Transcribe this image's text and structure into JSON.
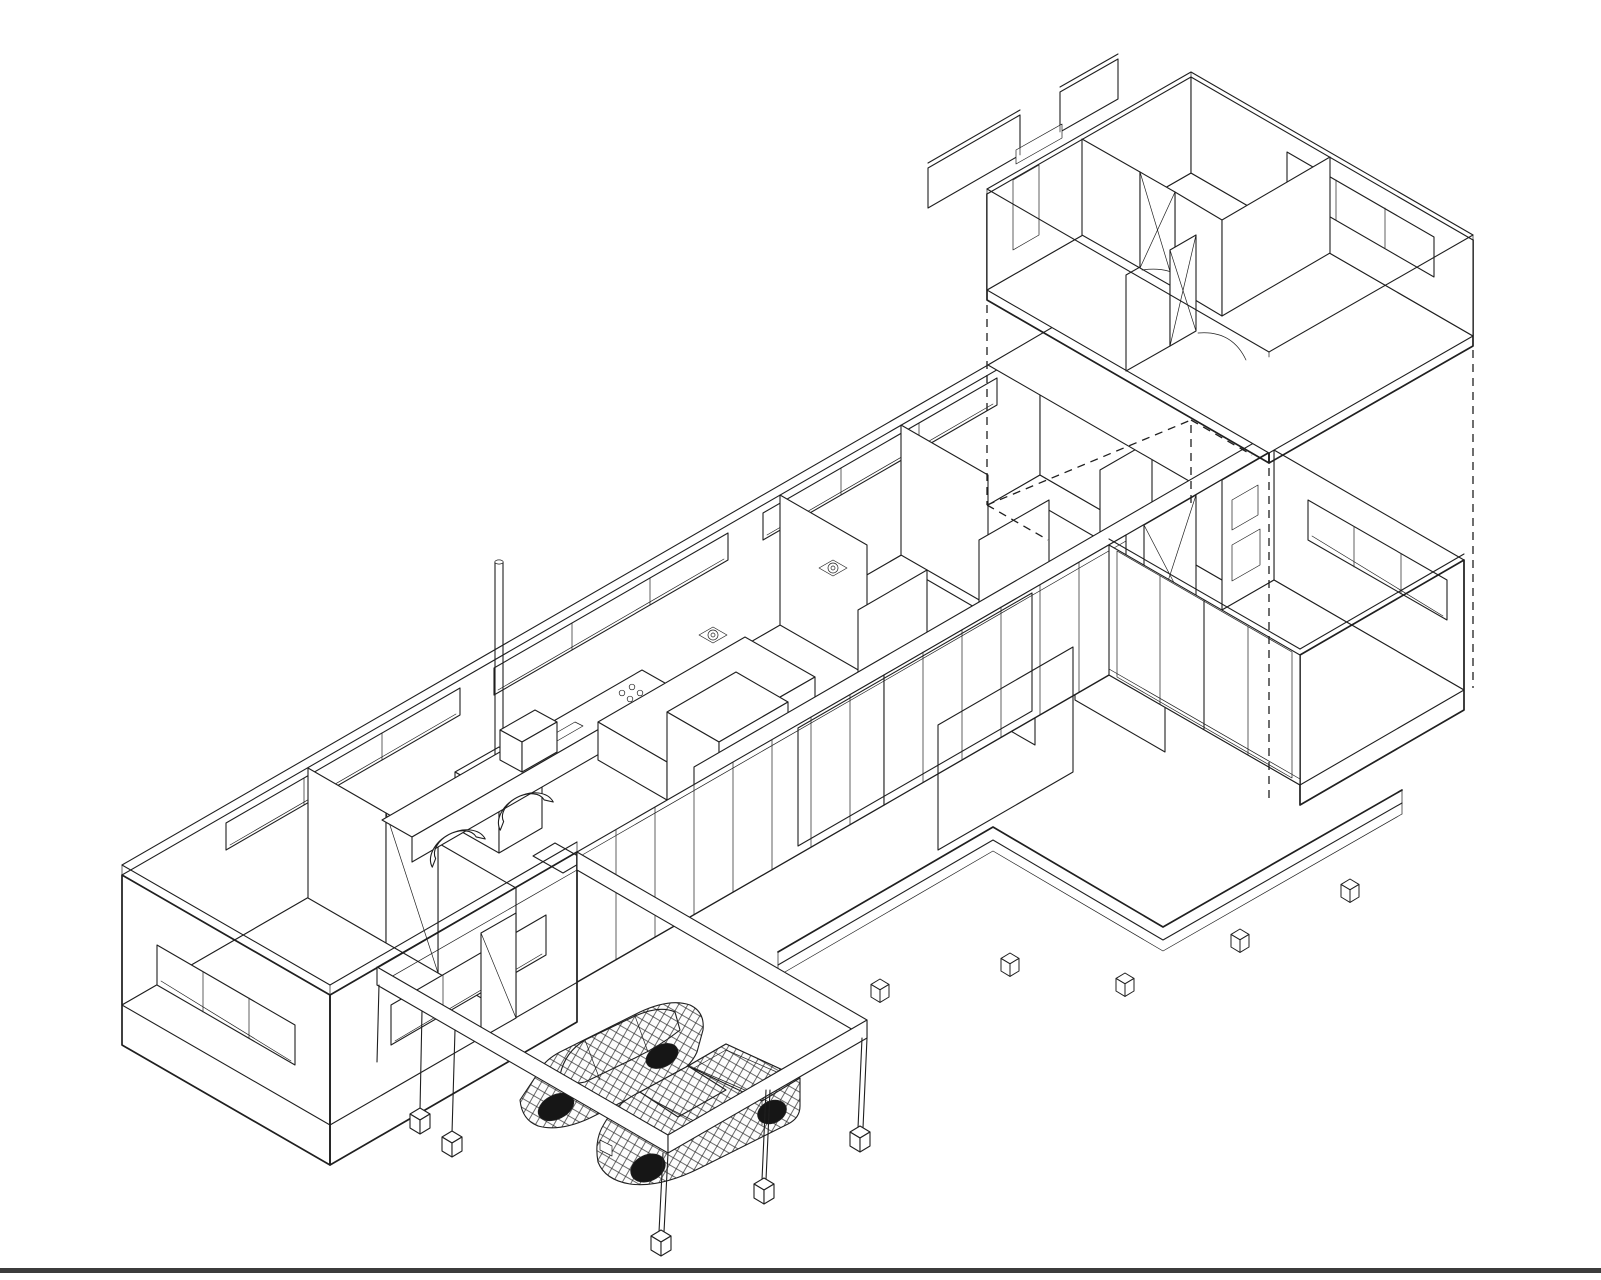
{
  "scene": {
    "style_vars": "--bg:#ffffff;--ln:#1f1f1f;--border:#3c3c3c",
    "background": "#ffffff",
    "line_color": "#1f1f1f",
    "border_color": "#3c3c3c",
    "drawing_type": "exploded axonometric architectural line drawing",
    "projection": "isometric 30-degree",
    "sheet_border_bottom": true
  },
  "components": {
    "upper_floor_module": "detached upper-storey box with open top, interior partitions, vertical board cladding and ribbon windows",
    "projection_lines": "vertical dashed lines locating the lifted module over the ground floor",
    "ground_floor": "long open-top floor plan with lounge, kitchen-dining, bedrooms, bathrooms, entry and stair",
    "right_wing": "single-storey wing with vertical cladding and full-height sliding glazing",
    "lounge_wing": "left end with horizontal lap cladding and ribbon windows",
    "carport": "open beam frame on slender posts with cube footings",
    "vehicles": [
      "wireframe SUV",
      "wireframe pickup truck"
    ],
    "deck": "L-shaped timber deck edge with pad footings",
    "louvre_screens": "freestanding horizontal-slat privacy screens",
    "slat_screens": "vertical slat screens beside the stair",
    "furniture": [
      "wood stove with flue",
      "kitchen island",
      "bench",
      "rear counter with sink and cooktop",
      "tall cabinets",
      "armchairs",
      "side table",
      "shower drains"
    ]
  },
  "counts": {
    "vehicles": 2,
    "clerestory_windows": 3,
    "footing_cubes": 10
  }
}
